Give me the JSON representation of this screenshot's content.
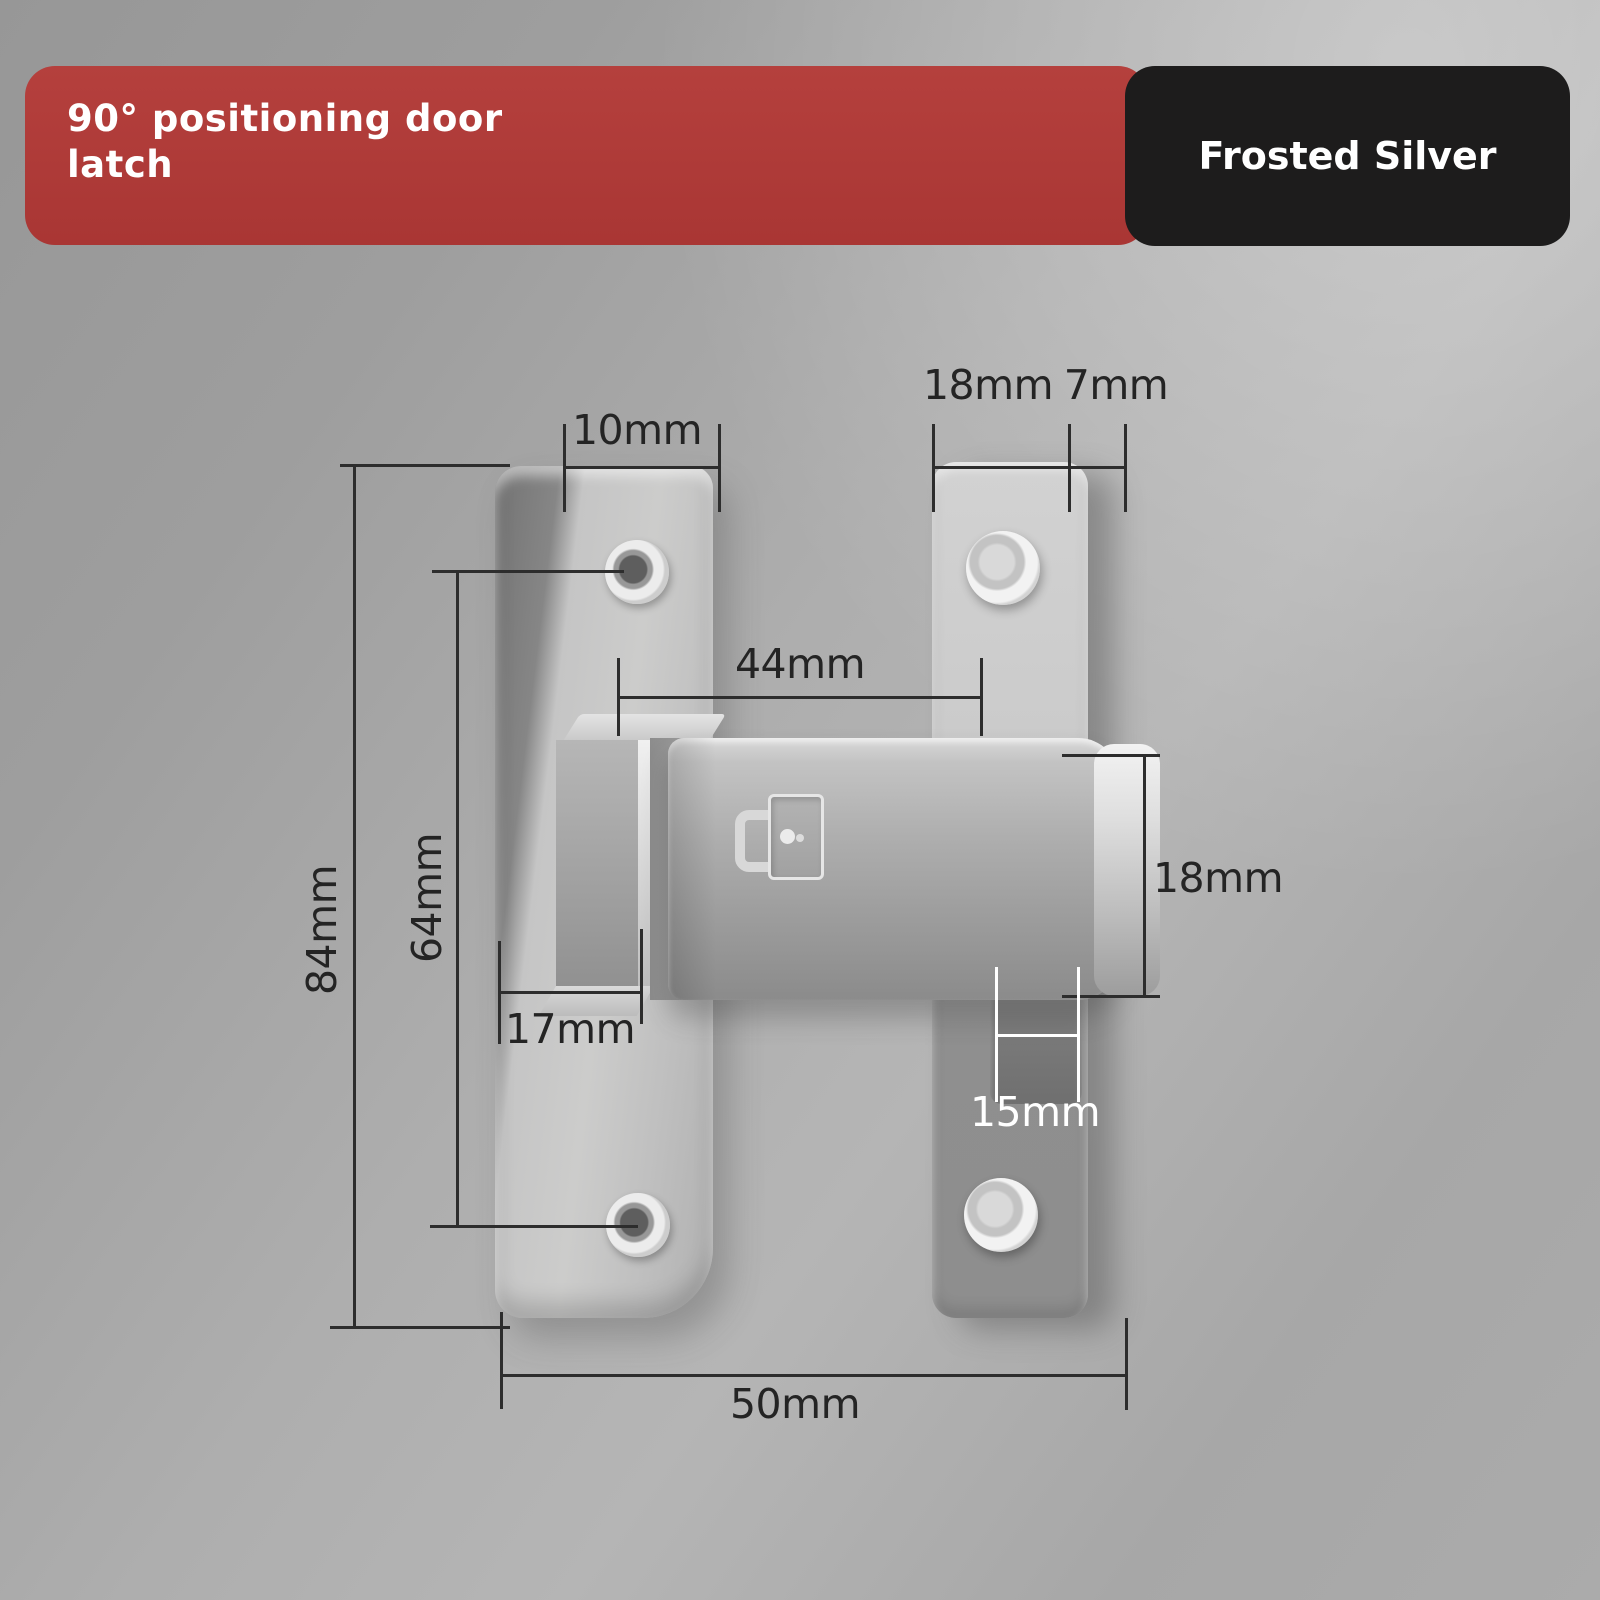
{
  "header": {
    "title": "90° positioning door latch",
    "subtitle": "(Precision cast zinc alloy)",
    "badge": "Frosted Silver"
  },
  "colors": {
    "banner_red": "#b13c3a",
    "badge_black": "#1d1c1c",
    "background_gray": "#a8a8a8",
    "metal_silver": "#c0c0c0",
    "dimension_line": "#2d2d2d",
    "dimension_text_dark": "#242424",
    "dimension_text_light": "#ffffff"
  },
  "dimensions": {
    "left_plate_top_width": "10mm",
    "right_plate_width": "18mm",
    "right_plate_thickness": "7mm",
    "hole_span_horizontal": "44mm",
    "plate_height": "84mm",
    "hole_span_vertical": "64mm",
    "pivot_base_width": "17mm",
    "latch_bar_height": "18mm",
    "catch_block_width": "15mm",
    "overall_width": "50mm"
  }
}
